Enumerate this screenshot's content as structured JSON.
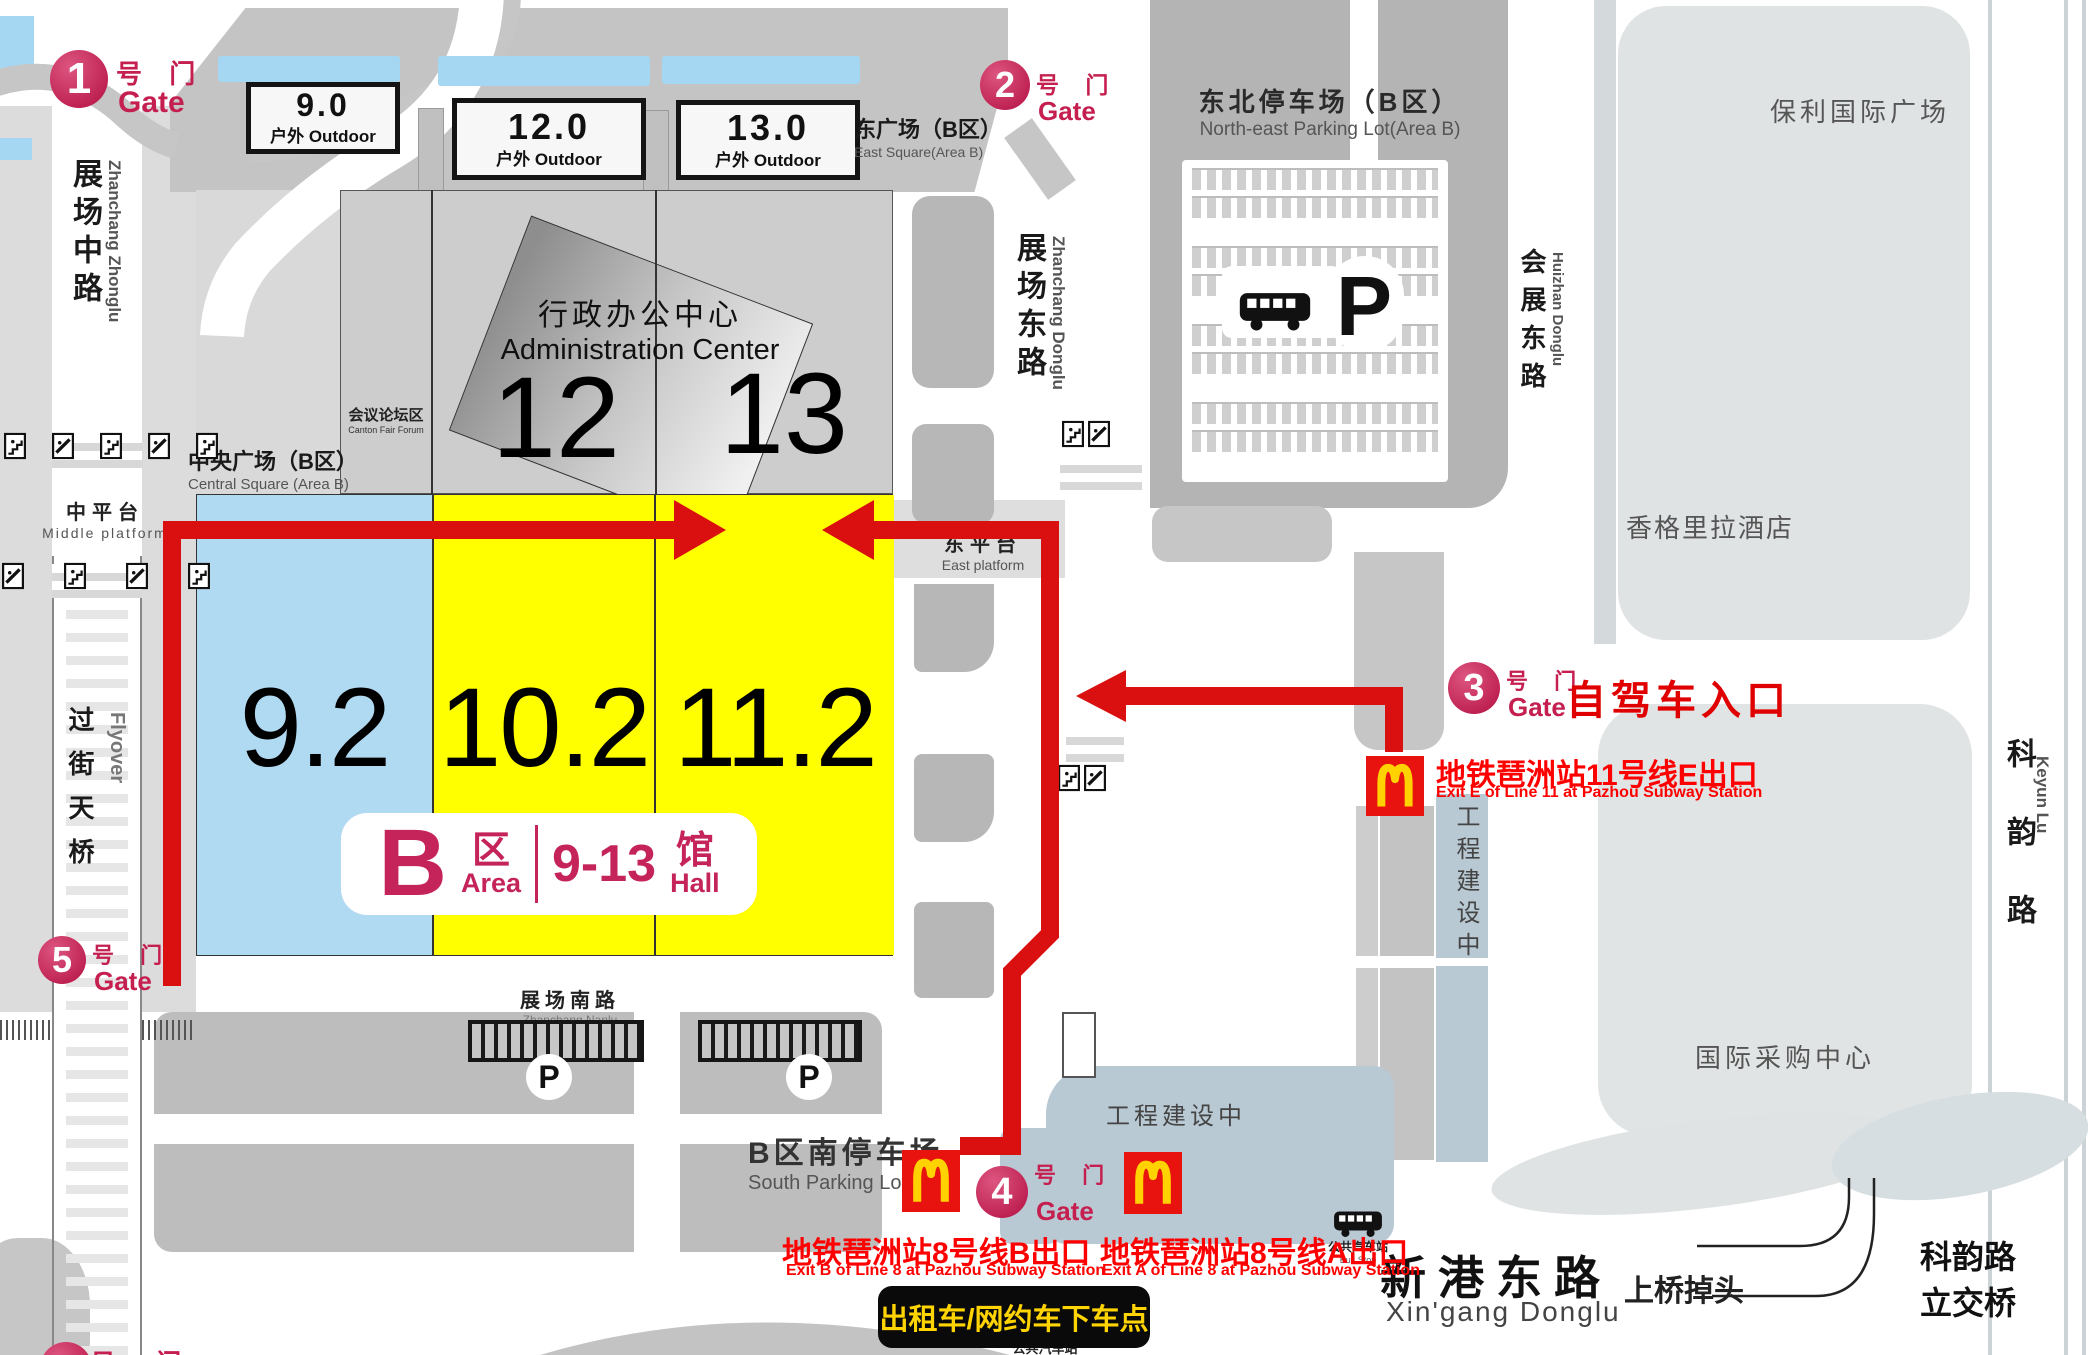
{
  "gates": {
    "g1": {
      "num": "1",
      "cn": "号 门",
      "en": "Gate"
    },
    "g2": {
      "num": "2",
      "cn": "号 门",
      "en": "Gate"
    },
    "g3": {
      "num": "3",
      "cn": "号 门",
      "en": "Gate"
    },
    "g4": {
      "num": "4",
      "cn": "号 门",
      "en": "Gate"
    },
    "g5": {
      "num": "5",
      "cn": "号 门",
      "en": "Gate"
    },
    "g6_partial": {
      "cn": "号 门"
    }
  },
  "halls": {
    "h9_2": "9.2",
    "h10_2": "10.2",
    "h11_2": "11.2",
    "h12": "12",
    "h13": "13"
  },
  "area_badge": {
    "letter": "B",
    "qu": "区",
    "area": "Area",
    "range": "9-13",
    "guan": "馆",
    "hall": "Hall"
  },
  "outdoor_boxes": [
    {
      "num": "9.0",
      "label": "户外 Outdoor"
    },
    {
      "num": "12.0",
      "label": "户外 Outdoor"
    },
    {
      "num": "13.0",
      "label": "户外 Outdoor"
    }
  ],
  "admin_center": {
    "cn": "行政办公中心",
    "en": "Administration Center"
  },
  "forum": {
    "cn": "会议论坛区",
    "en": "Canton Fair Forum"
  },
  "squares": {
    "central": {
      "cn": "中央广场（B区）",
      "en": "Central Square (Area  B)"
    },
    "east": {
      "cn": "东广场（B区）",
      "en": "East Square(Area B)"
    }
  },
  "platforms": {
    "middle": {
      "cn": "中平台",
      "en": "Middle platform"
    },
    "east": {
      "cn": "东平台",
      "en": "East platform"
    }
  },
  "roads": {
    "zhanchang_zhonglu": {
      "cn": "展场中路",
      "en": "Zhanchang Zhonglu"
    },
    "zhanchang_donglu": {
      "cn": "展场东路",
      "en": "Zhanchang Donglu"
    },
    "zhanchang_nanlu": {
      "cn": "展场南路",
      "en": "Zhanchang Nanlu"
    },
    "huizhan_donglu": {
      "cn": "会展东路",
      "en": "Huizhan Donglu"
    },
    "keyun_lu": {
      "cn": "科韵路",
      "en": "Keyun Lu"
    },
    "xingang_donglu": {
      "cn": "新港东路",
      "en": "Xin'gang Donglu"
    },
    "flyover": {
      "cn": "过街天桥",
      "en": "Flyover"
    },
    "keyun_interchange": {
      "line1": "科韵路",
      "line2": "立交桥"
    },
    "uturn": "上桥掉头"
  },
  "parking": {
    "northeast": {
      "cn": "东北停车场（B区）",
      "en": "North-east Parking Lot(Area B)",
      "p": "P"
    },
    "south": {
      "cn": "B区南停车场",
      "en": "South Parking Lot(Area",
      "p": "P"
    }
  },
  "buildings": {
    "poly": "保利国际广场",
    "shangrila": "香格里拉酒店",
    "isc": "国际采购中心",
    "construction": "工程建设中"
  },
  "subway_exits": {
    "exit_b": {
      "cn": "地铁琶洲站8号线B出口",
      "en": "Exit B of Line 8 at Pazhou Subway Station"
    },
    "exit_a": {
      "cn": "地铁琶洲站8号线A出口",
      "en": "Exit A of Line 8 at Pazhou Subway Station"
    },
    "exit_e": {
      "cn": "地铁琶洲站11号线E出口",
      "en": "Exit E of Line 11 at Pazhou Subway Station"
    }
  },
  "annotations": {
    "self_drive": "自驾车入口",
    "taxi_dropoff": "出租车/网约车下车点",
    "bus_stop_cn": "公共汽车站",
    "bus_stop_en": "Bus Stop"
  },
  "colors": {
    "hall_yellow": "#ffff00",
    "hall_blue": "#b0d9f2",
    "route_red": "#da1010",
    "gate_crimson": "#c51f50",
    "subway_red": "#ff0000",
    "mcd_red": "#e8120f",
    "mcd_yellow": "#ffd200",
    "taxi_bg": "#000000",
    "taxi_text": "#ffd400",
    "water_blue": "#a6d7f2",
    "construction_blue": "#b9c9d3"
  }
}
